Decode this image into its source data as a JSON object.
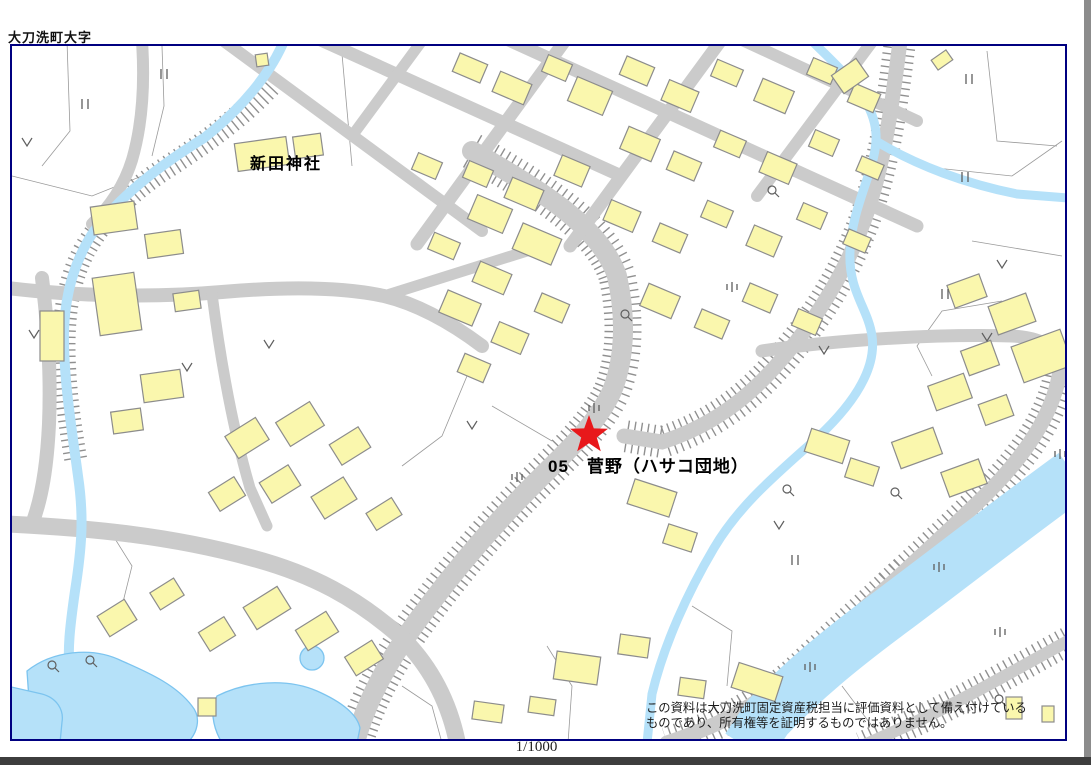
{
  "window": {
    "title_label": "大刀洗町大字",
    "scale_label": "1/1000"
  },
  "map": {
    "shrine_label": "新田神社",
    "location_label": "05　菅野（ハサコ団地）",
    "marker": {
      "shape": "star",
      "color": "#e8181b"
    },
    "disclaimer": {
      "line1": "この資料は大刀洗町固定資産税担当に評価資料として備え付けている",
      "line2": "ものであり、所有権等を証明するものではありません。"
    },
    "colors": {
      "building_fill": "#FAF7AD",
      "building_stroke": "#8C8C8C",
      "road": "#CBCBCB",
      "water": "#B5E1F9",
      "water_stroke": "#7CC4EF",
      "frame": "#000080",
      "parcel_line": "#9A9A9A",
      "symbol": "#5f5f5f",
      "hatch": "#909090"
    }
  }
}
